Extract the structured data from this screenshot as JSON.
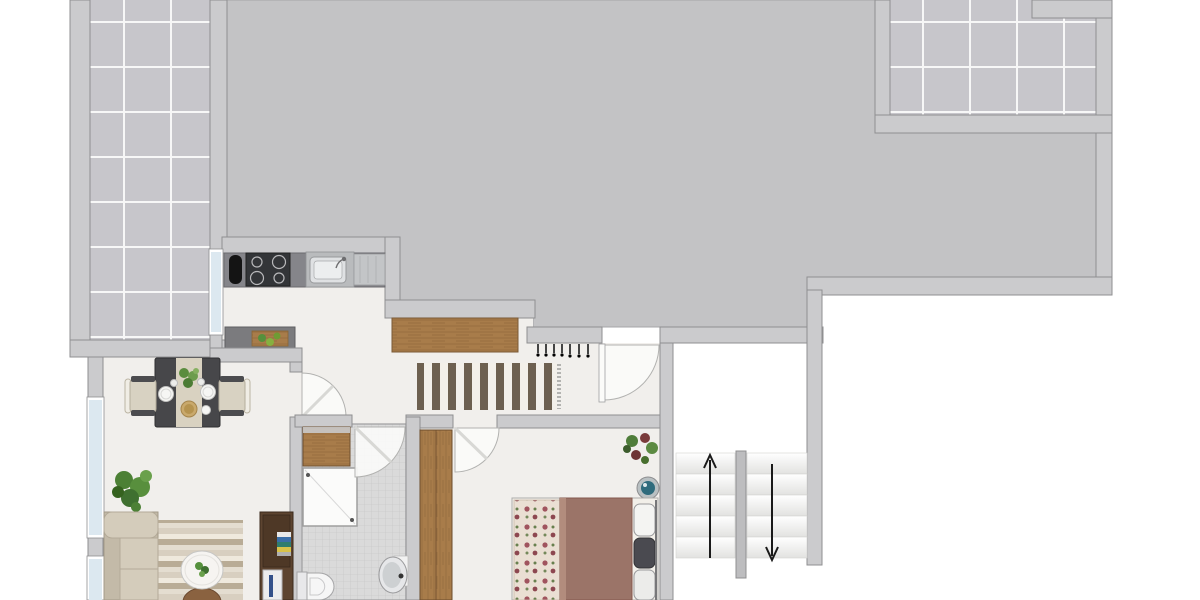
{
  "canvas": {
    "width": 1200,
    "height": 600,
    "background": "#ffffff"
  },
  "palette": {
    "roof": "#c3c3c5",
    "roof-edge": "#a6a6a8",
    "wall": "#cbcbcd",
    "wall-edge": "#8f8f91",
    "floor": "#f1efec",
    "tile": "#c7c6cb",
    "grout": "#ffffff",
    "bath-floor": "#dadada",
    "bath-grid": "#c9c9c9",
    "counter": "#85858a",
    "counter-dark": "#7b7b7e",
    "appliance-dark": "#333538",
    "steel": "#c3c5c7",
    "wood": "#a87c4a",
    "wood-dark": "#6b4c2c",
    "window-glass": "#dce8f0",
    "rug-dark": "#6d6050",
    "rug-light": "#f3f0ea",
    "living-rug-a": "#d8cfc0",
    "living-rug-b": "#efe9dd",
    "living-rug-c": "#b9ac96",
    "living-rug-d": "#e4ddd0",
    "sofa": "#d4ccbb",
    "sofa-back": "#c3baa8",
    "table-dark": "#47474a",
    "runner": "#d9d2c1",
    "duvet": "#9b7468",
    "floral-base": "#eadfd3",
    "floral-rose": "#a0545e",
    "plant-green": "#55903c",
    "accent-teal": "#2f6b7c",
    "divider": "#bdbdbf",
    "arrow": "#1a1a1a",
    "ottoman-brown": "#8a6240",
    "book-blue": "#3a6ea8",
    "book-teal": "#2f7d6e",
    "book-yellow": "#d8c24a",
    "shelf-brown": "#5d4430",
    "door-arc": "#b2b2b0"
  },
  "areas": [
    "roof-area",
    "terrace-top-left",
    "terrace-top-right",
    "kitchen",
    "living-dining-room",
    "hallway",
    "bathroom",
    "bedroom",
    "stairwell"
  ],
  "furniture": [
    "kitchen-counter",
    "tray",
    "stove",
    "sink",
    "drainer",
    "prep-counter",
    "cutting-board",
    "dining-table",
    "table-runner",
    "dining-chair-left",
    "dining-chair-right",
    "plates",
    "centerpiece-plant",
    "serving-bowl",
    "floor-plant",
    "sofa",
    "living-rug",
    "coffee-table",
    "ottoman",
    "bookshelf",
    "books",
    "tv-panel",
    "sideboard",
    "hallway-rug",
    "coat-hooks",
    "wardrobe",
    "bed",
    "floral-blanket",
    "duvet",
    "pillows",
    "bedroom-plant",
    "decor-bowl",
    "bathroom-cabinet",
    "shower",
    "toilet",
    "washbasin",
    "stairs-up-flight",
    "stairs-down-flight",
    "stair-divider"
  ],
  "stairs": {
    "up_arrow": true,
    "down_arrow": true,
    "treads_per_flight": 5
  },
  "doors": [
    "entrance-door",
    "living-room-door",
    "bathroom-door",
    "bedroom-door"
  ],
  "windows": [
    "kitchen-window",
    "living-window-upper",
    "living-window-lower"
  ]
}
